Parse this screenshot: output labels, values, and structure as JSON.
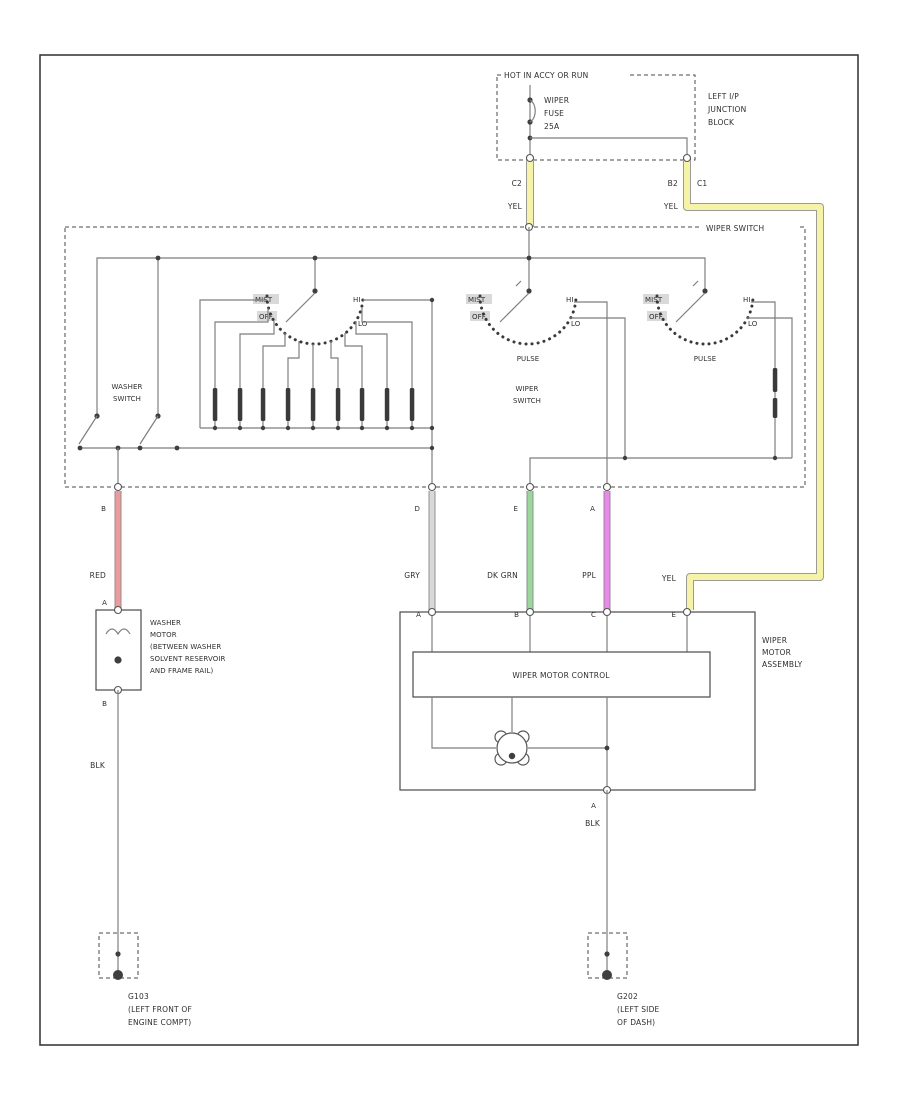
{
  "palette": {
    "yellow": "#f7f3a4",
    "red": "#ef9a9a",
    "green": "#98d898",
    "purple": "#ee86ee",
    "gray_wire": "#d8d8d8",
    "line": "#7e7e7e"
  },
  "fuse_block": {
    "header": "HOT IN ACCY OR RUN",
    "fuse": [
      "WIPER",
      "FUSE",
      "25A"
    ],
    "location": [
      "LEFT I/P",
      "JUNCTION",
      "BLOCK"
    ],
    "conn_left": "C2",
    "conn_left_color": "YEL",
    "conn_right": "B2",
    "conn_right_color": "YEL",
    "conn_right2": "C1"
  },
  "switch_box": {
    "label": "WIPER SWITCH",
    "washer": [
      "WASHER",
      "SWITCH"
    ],
    "positions": {
      "mist": "MIST",
      "off": "OFF",
      "hi": "HI",
      "lo": "LO"
    },
    "pulse": "PULSE",
    "center_caption": [
      "WIPER",
      "SWITCH"
    ]
  },
  "outputs": {
    "red": {
      "pin": "B",
      "label": "RED"
    },
    "gry": {
      "pin": "D",
      "label": "GRY"
    },
    "dk_grn": {
      "pin": "E",
      "label": "DK GRN"
    },
    "ppl": {
      "pin": "A",
      "label": "PPL"
    },
    "yel": {
      "label": "YEL"
    }
  },
  "washer_motor": {
    "pin_top": "A",
    "pin_bottom": "B",
    "wire": "BLK",
    "label": [
      "WASHER",
      "MOTOR",
      "(BETWEEN WASHER",
      "SOLVENT RESERVOIR",
      "AND FRAME RAIL)"
    ]
  },
  "wiper_motor": {
    "label": [
      "WIPER",
      "MOTOR",
      "ASSEMBLY"
    ],
    "control": "WIPER MOTOR CONTROL",
    "pins": [
      "A",
      "B",
      "C",
      "E"
    ],
    "pin_bottom": "A",
    "wire": "BLK"
  },
  "grounds": {
    "left": [
      "G103",
      "(LEFT FRONT OF",
      "ENGINE COMPT)"
    ],
    "right": [
      "G202",
      "(LEFT SIDE",
      "OF DASH)"
    ]
  }
}
